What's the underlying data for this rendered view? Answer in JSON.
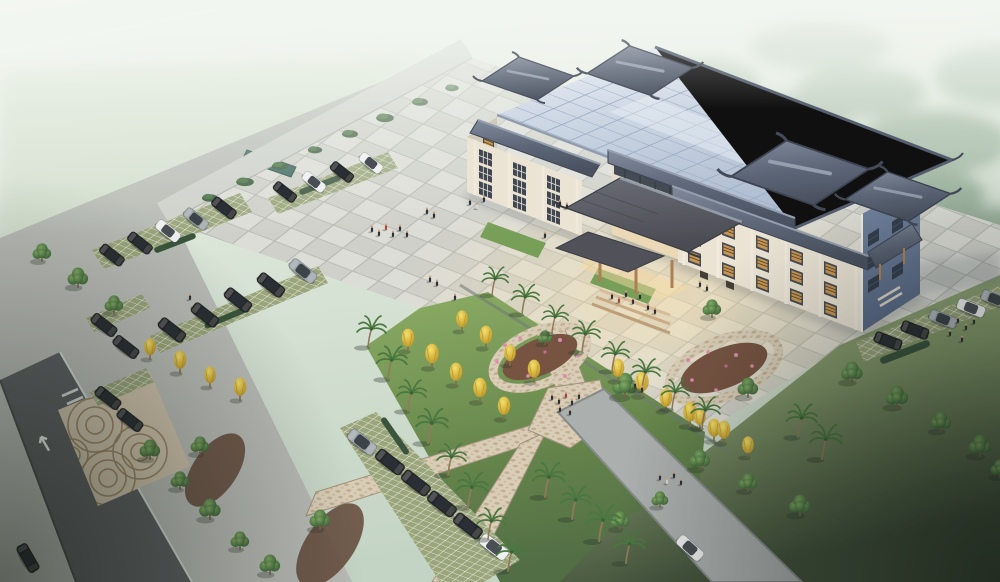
{
  "scene": {
    "kind": "aerial-architectural-rendering",
    "subject": "Chinese traditional-style multi-storey office building with entrance canopy, forecourt plaza, landscaped gardens, parking lots and perimeter roads",
    "view": "bird's-eye three-quarter view, hazy daylight, misty green background",
    "weather": "foggy / hazy"
  },
  "palette": {
    "mist_top": "#f2f6f0",
    "mist_green": "#c6d6c5",
    "forest": "#7d9b80",
    "plaza_light": "#dcddd6",
    "plaza_dark": "#c9cbc3",
    "plaza_warm": "#f0e2c8",
    "facade_light": "#ece5d4",
    "facade_shade": "#cfc9b8",
    "facade_blue": "#64779a",
    "roof_flat": "#c3cfdf",
    "roof_trad": "#555f72",
    "canopy_roof": "#4c4d55",
    "wood": "#b07c3f",
    "window_dark": "#3b424c",
    "lattice_orange": "#d99a45",
    "grass_field": "#8aa070",
    "grass_garden": "#6f9150",
    "grass_dark": "#36462f",
    "tree_green": "#49743c",
    "tree_dark": "#2f5230",
    "palm_green": "#3f7034",
    "ginkgo_yellow": "#e3c43a",
    "mulch_brown": "#6f4a36",
    "flower_pink": "#d98aa6",
    "path_tan": "#d9ccb5",
    "road_dark": "#53585a",
    "sidewalk_gray": "#ccd0c9",
    "paver_green": "#95a175",
    "car_black": "#15171a",
    "car_white": "#eef0f1",
    "car_silver": "#9aa2a8",
    "pool_teal": "#2e5d55",
    "people_dark": "#20242b"
  },
  "objects": {
    "building": {
      "label": "chinese-style-office-building",
      "floors": 4,
      "wings": [
        "left-wing",
        "recessed-center",
        "right-wing"
      ],
      "roof_pavilions": 4,
      "entrance": "traditional-gabled-canopy-with-wood-columns",
      "window_style": "dark frames with orange lattice shutters"
    },
    "plaza": {
      "paving": "checkerboard granite tiles",
      "green_insets": 2,
      "teal_hedge_strips": 1
    },
    "parking": {
      "upper_left_rows": 3,
      "lower_left_clusters": 2,
      "bottom_center_row": 1,
      "right_strip": 1,
      "surface": "grass-grid pavers"
    },
    "vehicles": {
      "total": 31,
      "black": 20,
      "white": 6,
      "silver": 5
    },
    "roads": {
      "left_road": "dark asphalt with white turn arrow and crosswalk bars",
      "entry_apron": "fan-pattern stone paving",
      "southeast_road": "stone paved lane"
    },
    "garden": {
      "paths": "mosaic cross walkways",
      "ringed_flower_beds": 2,
      "mulch_beds": 2,
      "lawn": "sloped green lawns"
    },
    "vegetation": {
      "palm_trees": 22,
      "ginkgo_yellow_trees": 21,
      "round_green_trees": 24,
      "bushes_hedges": 15
    },
    "people": {
      "count": 45,
      "groups": [
        "plaza-center",
        "building-entrance",
        "garden-crossing",
        "right-plaza",
        "sidewalk"
      ]
    }
  }
}
